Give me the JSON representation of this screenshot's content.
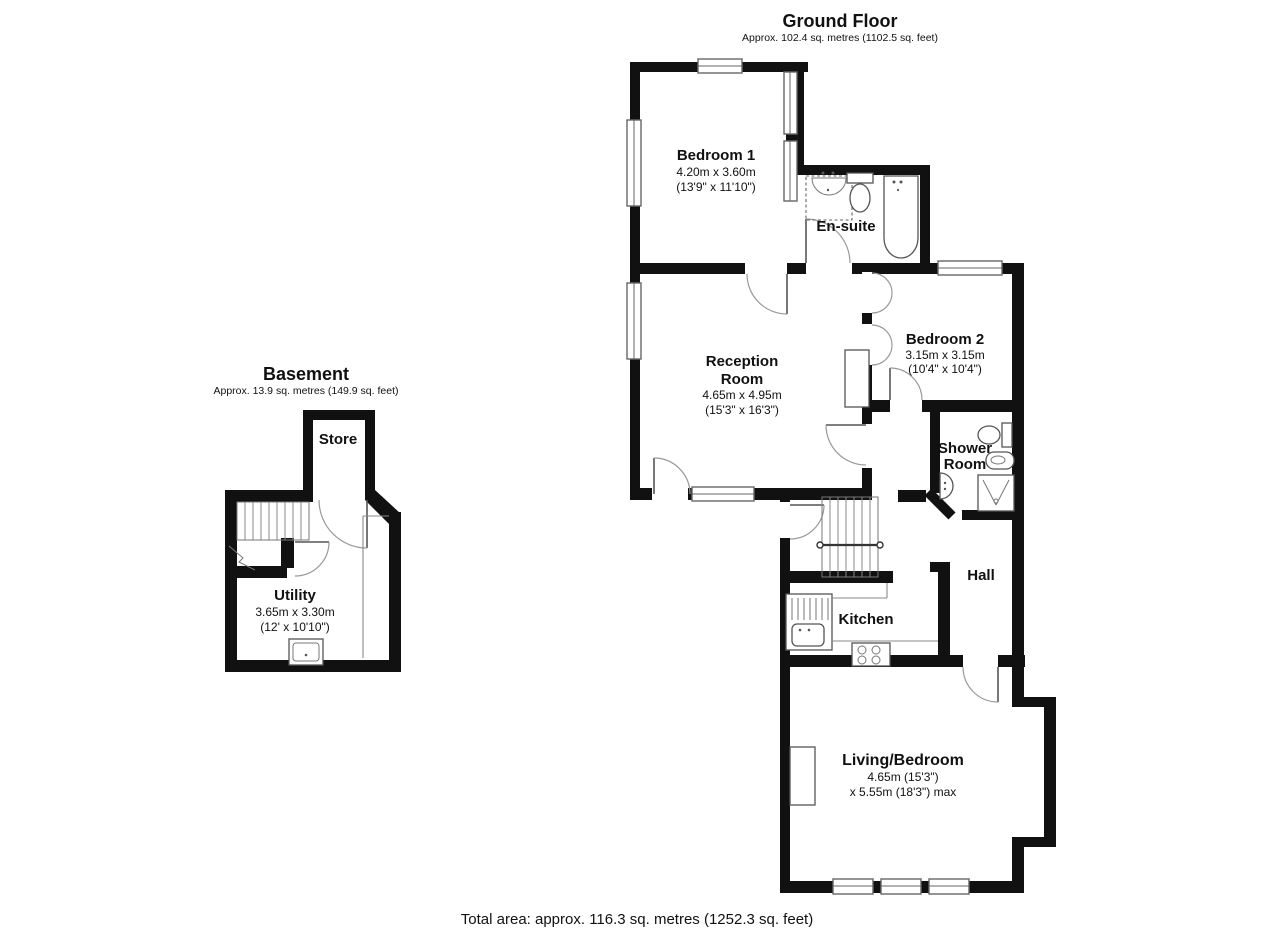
{
  "ground_floor": {
    "title": "Ground Floor",
    "subtitle": "Approx. 102.4 sq. metres (1102.5 sq. feet)",
    "rooms": {
      "bedroom1": {
        "name": "Bedroom 1",
        "dims_m": "4.20m x 3.60m",
        "dims_ft": "(13'9\" x 11'10\")"
      },
      "ensuite": {
        "name": "En-suite"
      },
      "reception": {
        "name_line1": "Reception",
        "name_line2": "Room",
        "dims_m": "4.65m x 4.95m",
        "dims_ft": "(15'3\" x 16'3\")"
      },
      "bedroom2": {
        "name": "Bedroom 2",
        "dims_m": "3.15m x 3.15m",
        "dims_ft": "(10'4\" x 10'4\")"
      },
      "shower_room": {
        "name_line1": "Shower",
        "name_line2": "Room"
      },
      "hall": {
        "name": "Hall"
      },
      "kitchen": {
        "name": "Kitchen"
      },
      "living_bedroom": {
        "name": "Living/Bedroom",
        "dims_line1": "4.65m (15'3\")",
        "dims_line2": "x 5.55m (18'3\") max"
      }
    }
  },
  "basement": {
    "title": "Basement",
    "subtitle": "Approx. 13.9 sq. metres (149.9 sq. feet)",
    "rooms": {
      "store": {
        "name": "Store"
      },
      "utility": {
        "name": "Utility",
        "dims_m": "3.65m x 3.30m",
        "dims_ft": "(12' x 10'10\")"
      }
    }
  },
  "footer": {
    "total_area": "Total area: approx. 116.3 sq. metres (1252.3 sq. feet)"
  },
  "colors": {
    "wall": "#111111",
    "fixture": "#555555",
    "text": "#111111",
    "background": "#ffffff"
  }
}
